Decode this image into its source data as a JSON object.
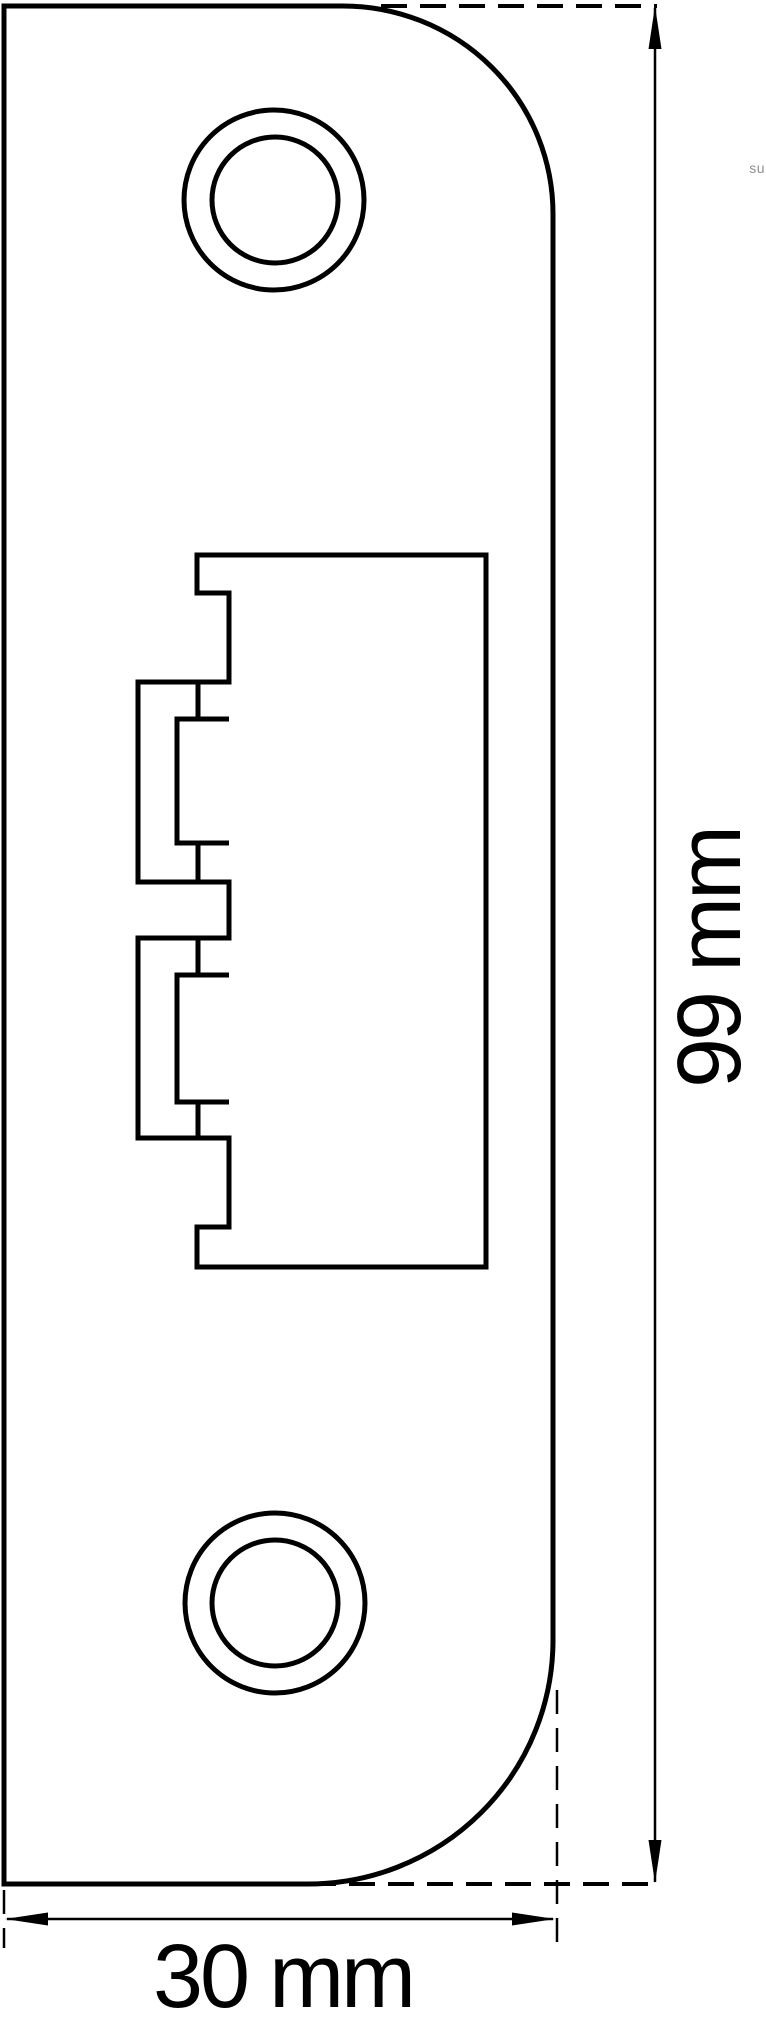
{
  "drawing": {
    "description": "Technical line drawing of a door strike plate, front view, with overall dimensions",
    "background_color": "#ffffff",
    "line_color": "#000000",
    "dimensions": {
      "height": {
        "label": "99 mm"
      },
      "width": {
        "label": "30 mm"
      }
    },
    "features": {
      "screw_hole_top": "double circle screw hole, upper",
      "screw_hole_bottom": "double circle screw hole, lower",
      "latch_cutout": "central rectangular latch opening with two keeper tabs on left edge"
    },
    "watermark": "su"
  }
}
